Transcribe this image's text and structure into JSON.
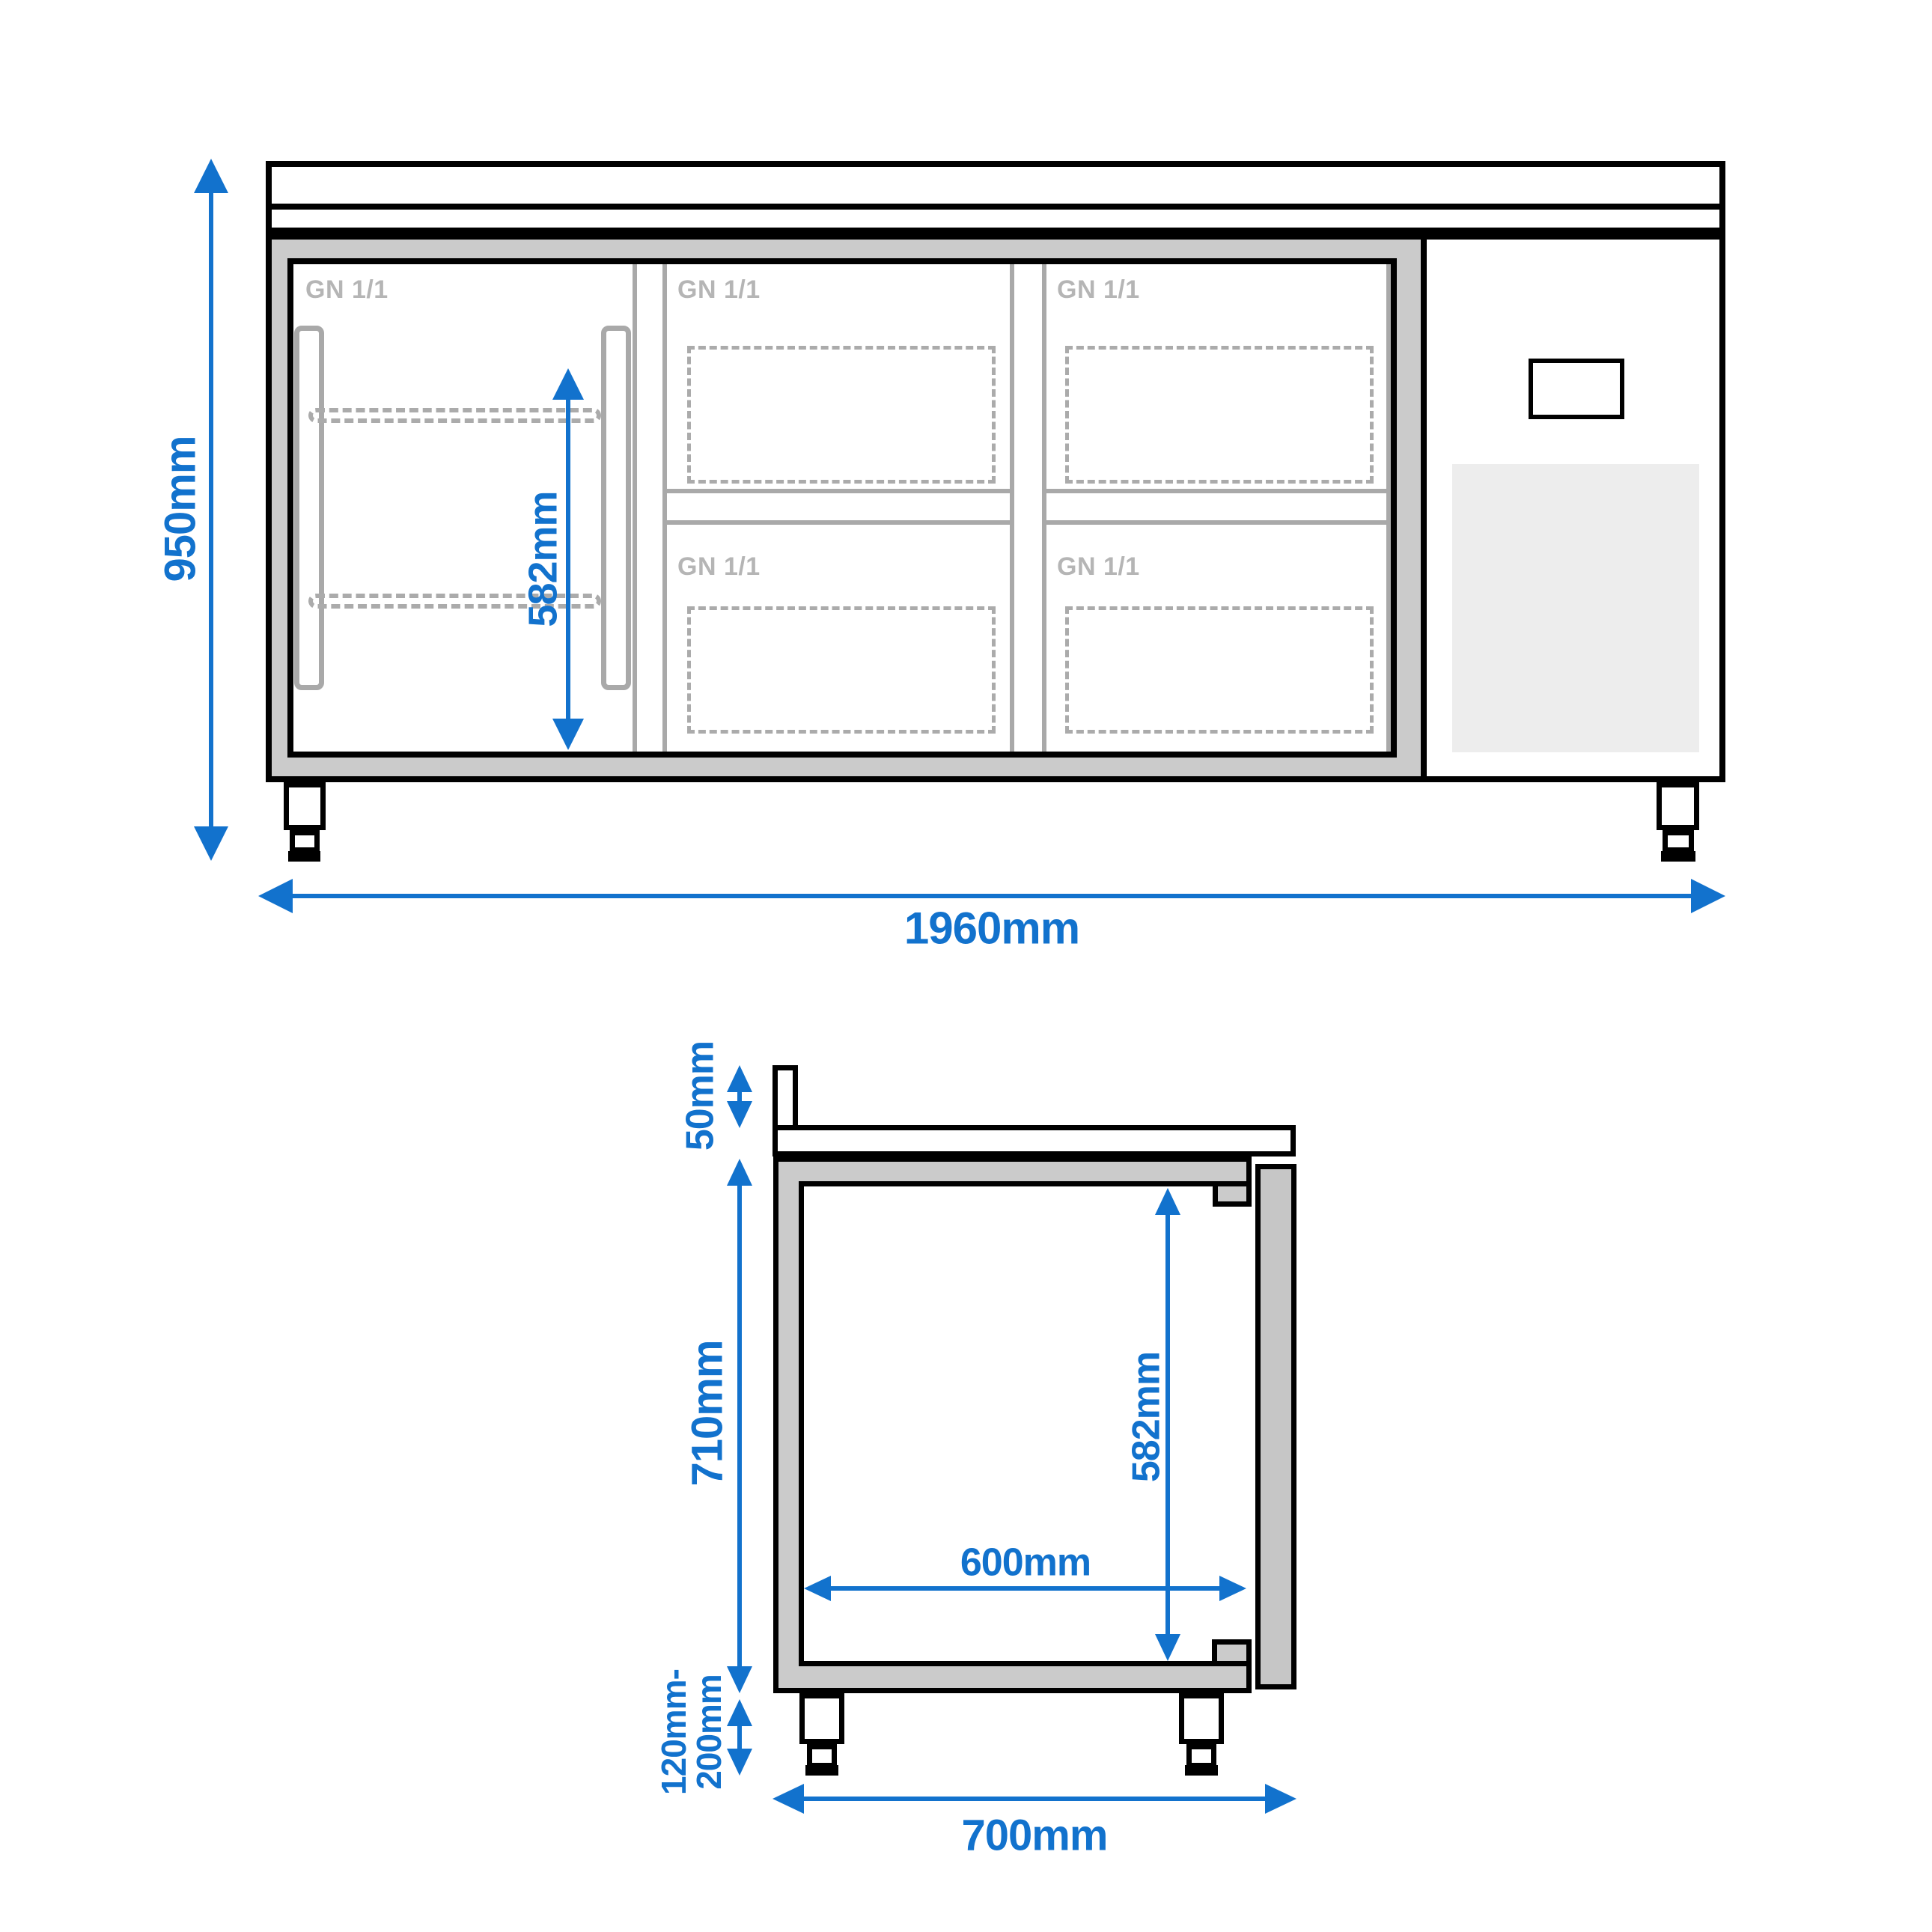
{
  "title": "Refrigerated counter technical dimension drawing",
  "colors": {
    "accent": "#1272cd",
    "body_gray": "#cbcbcb",
    "door_gray": "#c6c6c6",
    "line_gray": "#a9a9a9",
    "dash_gray": "#ababab",
    "gn_gray": "#b5b5b5",
    "grille_gray": "#ededed",
    "black": "#000000"
  },
  "front_view": {
    "name": "front elevation",
    "overall_height_label": "950mm",
    "overall_width_label": "1960mm",
    "inner_height_label": "582mm",
    "gn_labels": [
      "GN 1/1",
      "GN 1/1",
      "GN 1/1",
      "GN 1/1",
      "GN 1/1"
    ]
  },
  "side_view": {
    "name": "side section",
    "backsplash_height_label": "50mm",
    "body_height_label": "710mm",
    "inner_height_label": "582mm",
    "inner_depth_label": "600mm",
    "foot_height_label_line1": "120mm-",
    "foot_height_label_line2": "200mm",
    "overall_depth_label": "700mm"
  }
}
